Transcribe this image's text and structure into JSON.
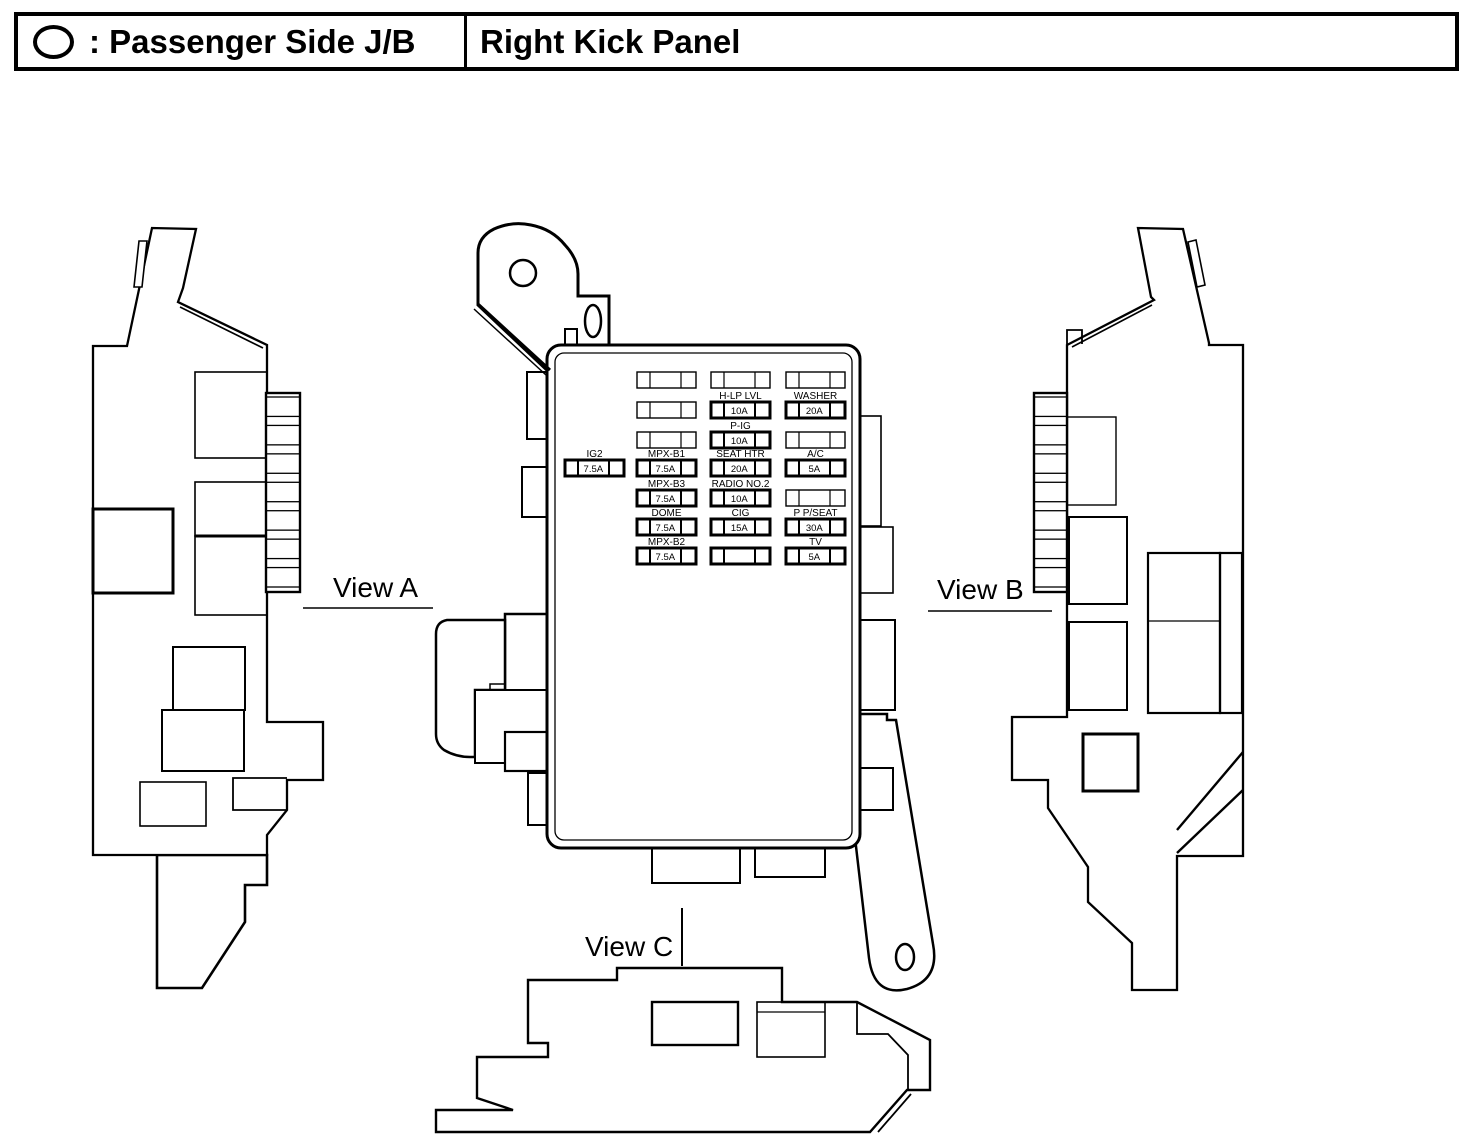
{
  "header": {
    "marker_icon": "junction-block-oval-icon",
    "marker_label": ": Passenger Side J/B",
    "location": "Right Kick Panel"
  },
  "view_labels": {
    "a": "View A",
    "b": "View B",
    "c": "View C"
  },
  "colors": {
    "ink": "#000000",
    "background": "#ffffff"
  },
  "fuse_panel": {
    "standalone": {
      "label": "IG2",
      "value": "7.5A",
      "bold": true
    },
    "columns": [
      {
        "name": "left",
        "rows": [
          {
            "label": "",
            "value": "",
            "bold": false
          },
          {
            "label": "",
            "value": "",
            "bold": false
          },
          {
            "label": "",
            "value": "",
            "bold": false
          },
          {
            "label": "MPX-B1",
            "value": "7.5A",
            "bold": true
          },
          {
            "label": "MPX-B3",
            "value": "7.5A",
            "bold": true
          },
          {
            "label": "DOME",
            "value": "7.5A",
            "bold": true
          },
          {
            "label": "MPX-B2",
            "value": "7.5A",
            "bold": true
          }
        ]
      },
      {
        "name": "center",
        "rows": [
          {
            "label": "",
            "value": "",
            "bold": false
          },
          {
            "label": "H-LP LVL",
            "value": "10A",
            "bold": true
          },
          {
            "label": "P-IG",
            "value": "10A",
            "bold": true
          },
          {
            "label": "SEAT HTR",
            "value": "20A",
            "bold": true
          },
          {
            "label": "RADIO NO.2",
            "value": "10A",
            "bold": true
          },
          {
            "label": "CIG",
            "value": "15A",
            "bold": true
          },
          {
            "label": "",
            "value": "",
            "bold": true
          }
        ]
      },
      {
        "name": "right",
        "rows": [
          {
            "label": "",
            "value": "",
            "bold": false
          },
          {
            "label": "WASHER",
            "value": "20A",
            "bold": true
          },
          {
            "label": "",
            "value": "",
            "bold": false
          },
          {
            "label": "A/C",
            "value": "5A",
            "bold": true
          },
          {
            "label": "",
            "value": "",
            "bold": false
          },
          {
            "label": "P P/SEAT",
            "value": "30A",
            "bold": true
          },
          {
            "label": "TV",
            "value": "5A",
            "bold": true
          }
        ]
      }
    ]
  }
}
